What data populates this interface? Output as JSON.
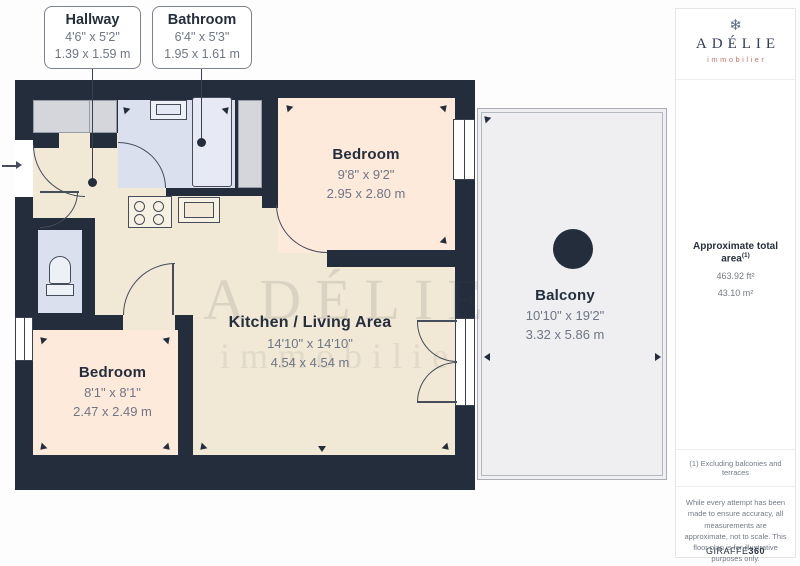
{
  "callouts": [
    {
      "room": "Hallway",
      "imperial": "4'6\" x 5'2\"",
      "metric": "1.39 x 1.59 m"
    },
    {
      "room": "Bathroom",
      "imperial": "6'4\" x 5'3\"",
      "metric": "1.95 x 1.61 m"
    }
  ],
  "rooms": {
    "bedroom_top": {
      "name": "Bedroom",
      "imperial": "9'8\" x 9'2\"",
      "metric": "2.95 x 2.80 m"
    },
    "kitchen_living": {
      "name": "Kitchen / Living Area",
      "imperial": "14'10\" x 14'10\"",
      "metric": "4.54 x 4.54 m"
    },
    "bedroom_bottom": {
      "name": "Bedroom",
      "imperial": "8'1\" x 8'1\"",
      "metric": "2.47 x 2.49 m"
    },
    "balcony": {
      "name": "Balcony",
      "imperial": "10'10\" x 19'2\"",
      "metric": "3.32 x 5.86 m"
    }
  },
  "watermark": {
    "line1": "ADÉLIE",
    "line2": "immobilier"
  },
  "sidebar": {
    "logo": {
      "icon_glyph": "❄",
      "name": "ADÉLIE",
      "tagline": "immobilier"
    },
    "area": {
      "title": "Approximate total area",
      "footnote_ref": "(1)",
      "imperial": "463.92 ft²",
      "metric": "43.10 m²"
    },
    "footnote": "(1) Excluding balconies and terraces",
    "disclaimer": "While every attempt has been made to ensure accuracy, all measurements are approximate, not to scale. This floor plan is for illustrative purposes only.",
    "credit": {
      "brand": "GIRAFFE",
      "suffix": "360"
    }
  },
  "colors": {
    "wall": "#232d3b",
    "floor_main": "#f1e9d6",
    "floor_bedroom": "#fdeada",
    "floor_bath": "#dbe0ee",
    "closet": "#d4d6dc",
    "balcony": "#efeff1",
    "brand_accent": "#c5756a"
  }
}
